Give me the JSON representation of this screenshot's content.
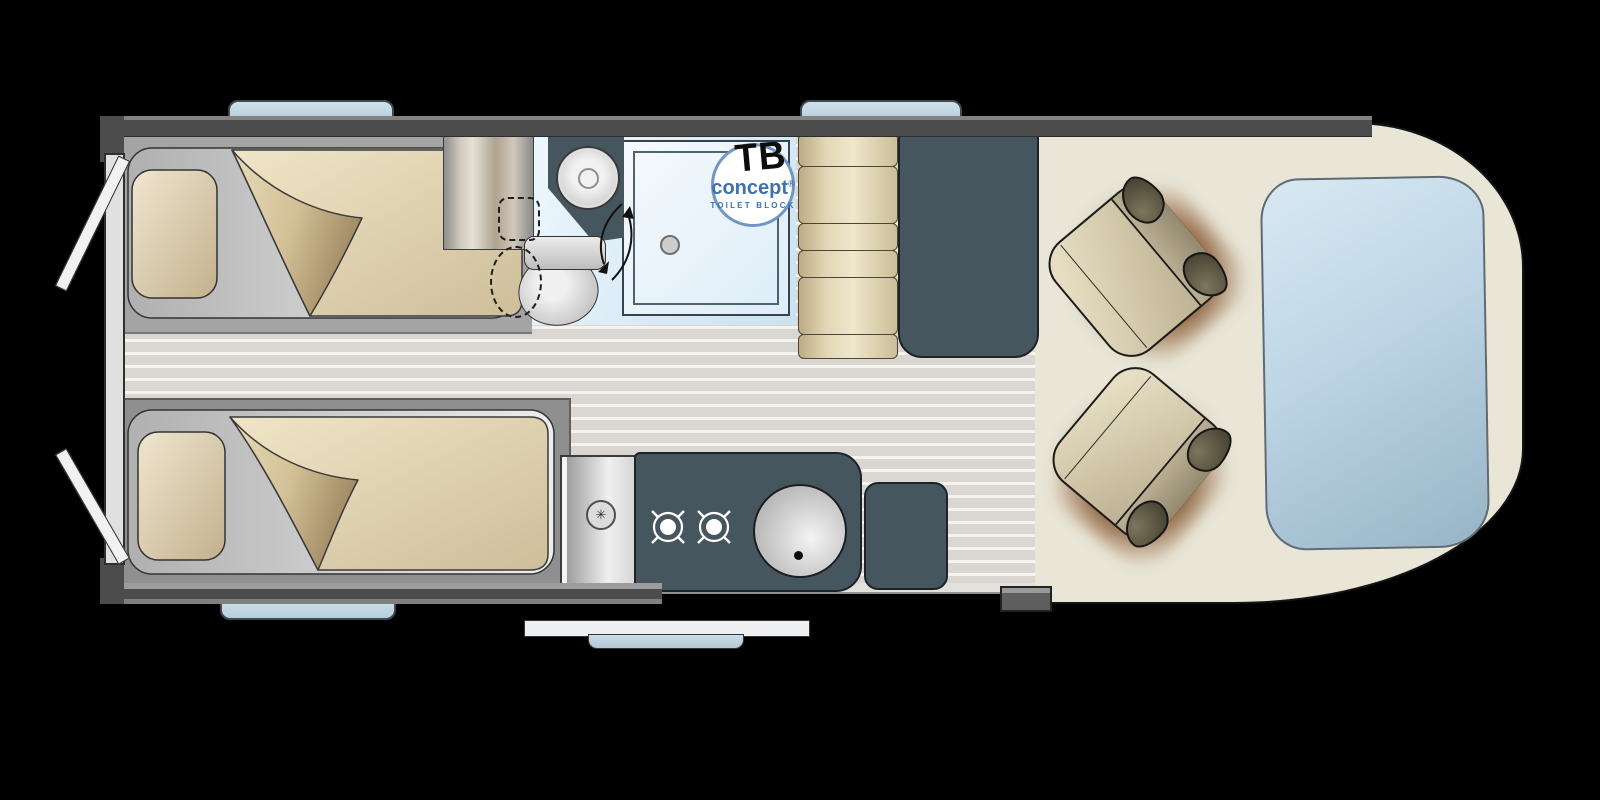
{
  "plan": {
    "type": "campervan-floorplan",
    "logo": {
      "tb": "TB",
      "concept": "concept",
      "registered": "®",
      "subtitle": "TOILET BLOCK"
    },
    "kitchen": {
      "symbol": "✳"
    },
    "colors": {
      "background": "#000000",
      "wall": "#4c4c4c",
      "floor_stripe": "#dad7d2",
      "furniture_slate": "#46565e",
      "cushion_beige": "#e6dcba",
      "bathroom_floor": "#d7ebf7",
      "cab_floor": "#e9e6d7",
      "window_blue": "#bcd4e0",
      "front_bed_blue": "#b9d2e2",
      "logo_blue": "#3f72b0"
    },
    "features": [
      "twin-single-beds",
      "wardrobe",
      "swivel-bathroom-wall",
      "shower",
      "toilet",
      "washbasin",
      "dinette-bench",
      "two-burner-hob",
      "kitchen-sink",
      "swivel-cab-seats",
      "front-bed",
      "sliding-door",
      "rear-doors",
      "entry-step",
      "windows"
    ]
  }
}
